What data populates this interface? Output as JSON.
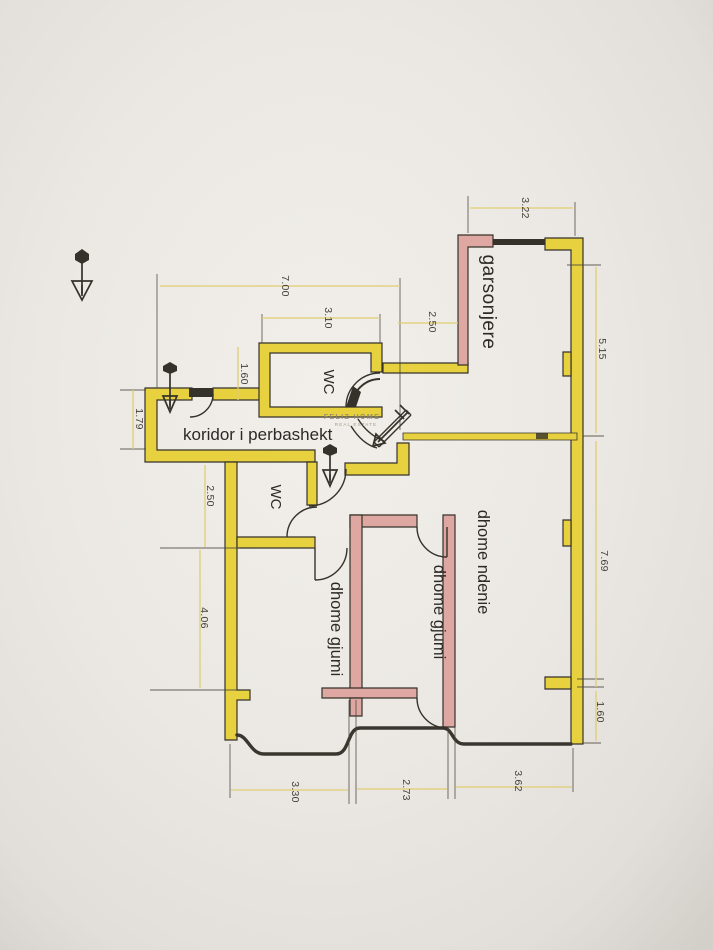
{
  "document": {
    "kind": "scanned apartment floor plan photo",
    "language": "Albanian"
  },
  "palette": {
    "paper": "#ebe8e3",
    "ink": "#35322b",
    "wall_highlight_yellow": "#e7d13e",
    "wall_highlight_pink": "#dfa7a1",
    "dimension_line": "#dfcd72",
    "watermark": "#93836f"
  },
  "watermark": {
    "line1": "FELIZ HOME",
    "line2": "REAL ESTATE"
  },
  "rooms": {
    "garsonjere": "garsonjere",
    "wc_top": "WC",
    "koridor": "koridor i perbashekt",
    "wc_bottom": "WC",
    "dhome_ndenie": "dhome ndenie",
    "dhome_gjumi_center": "dhome gjumi",
    "dhome_gjumi_left": "dhome gjumi"
  },
  "dimensions": {
    "top_width": "7.00",
    "wc_top_width": "3.10",
    "wc_top_left": "1.60",
    "entrance_left": "1.79",
    "garsonjere_top": "3.22",
    "garsonjere_left": "2.50",
    "right_upper": "5.15",
    "right_middle": "7.69",
    "right_lower": "1.60",
    "left_upper": "2.50",
    "left_lower": "4.06",
    "bottom_left": "3.30",
    "bottom_middle": "2.73",
    "bottom_right": "3.62"
  }
}
